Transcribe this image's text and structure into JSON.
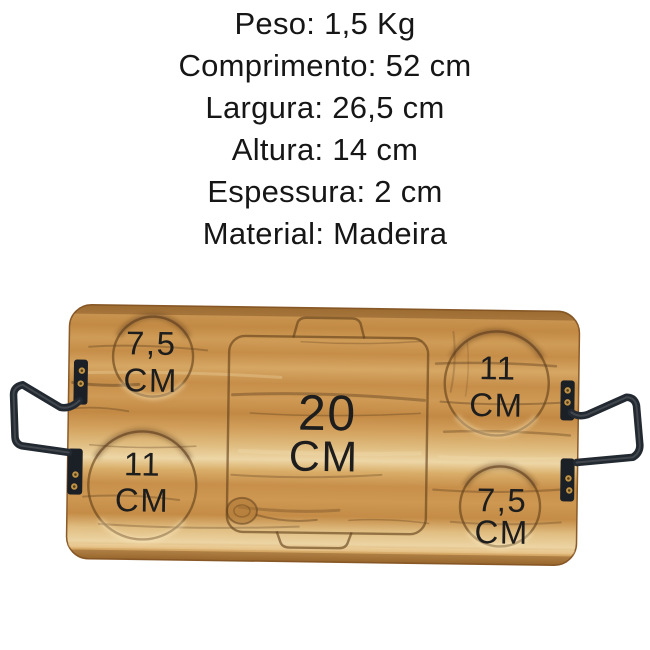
{
  "product_specs": {
    "lines": [
      "Peso: 1,5 Kg",
      "Comprimento: 52 cm",
      "Largura: 26,5 cm",
      "Altura: 14 cm",
      "Espessura: 2 cm",
      "Material: Madeira"
    ]
  },
  "board": {
    "description": "wooden serving board with carved recesses and metal handles",
    "recesses": [
      {
        "position": "top-left",
        "size": "7,5",
        "unit": "CM"
      },
      {
        "position": "top-right",
        "size": "11",
        "unit": "CM"
      },
      {
        "position": "center",
        "size": "20",
        "unit": "CM"
      },
      {
        "position": "bottom-left",
        "size": "11",
        "unit": "CM"
      },
      {
        "position": "bottom-right",
        "size": "7,5",
        "unit": "CM"
      }
    ]
  },
  "palette": {
    "background": "#ffffff",
    "spec_text": "#161616",
    "label_text": "#1d1d1d",
    "wood_base": "#c98f4a",
    "wood_light_band": "#edd6a6",
    "wood_dark_streak": "#5a3d1e",
    "board_edge": "#8a5a28",
    "handle_metal": "#232931",
    "mount_plate": "#1b1f26",
    "screw_brass": "#bf9448"
  }
}
